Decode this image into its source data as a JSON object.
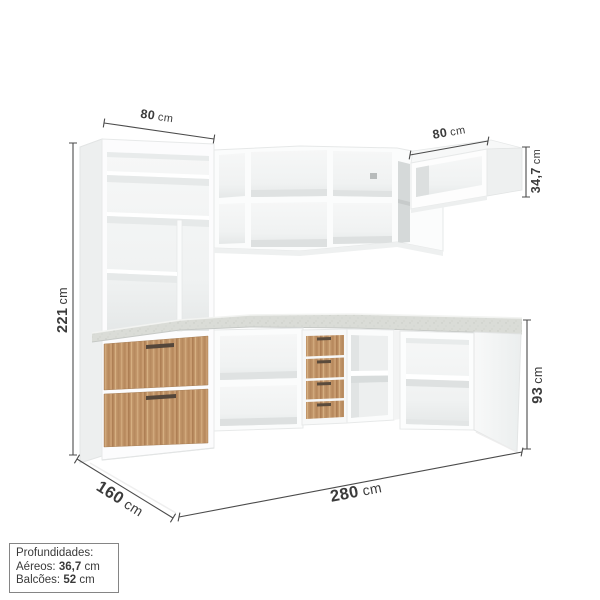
{
  "image_type": "furniture-dimension-diagram",
  "dimensions": {
    "tall_cabinet_width": {
      "value": "80",
      "unit": "cm"
    },
    "right_wall_cabinet_width": {
      "value": "80",
      "unit": "cm"
    },
    "wall_cabinet_height": {
      "value": "34,7",
      "unit": "cm"
    },
    "total_height": {
      "value": "221",
      "unit": "cm"
    },
    "base_cabinet_height": {
      "value": "93",
      "unit": "cm"
    },
    "total_width": {
      "value": "280",
      "unit": "cm"
    },
    "return_width": {
      "value": "160",
      "unit": "cm"
    }
  },
  "info_box": {
    "title": "Profundidades:",
    "lines": [
      {
        "label": "Aéreos:",
        "value": "36,7",
        "unit": "cm"
      },
      {
        "label": "Balcões:",
        "value": "52",
        "unit": "cm"
      }
    ]
  },
  "colors": {
    "dimension_line": "#4B4B4B",
    "text": "#3B3B3B",
    "cabinet_white": "#FCFCFC",
    "wood_base": "#C2966A",
    "wood_dark": "#A87C52",
    "wood_light": "#D8B284",
    "countertop": "#D9DCD8",
    "interior_shadow": "#E7E9E9"
  }
}
